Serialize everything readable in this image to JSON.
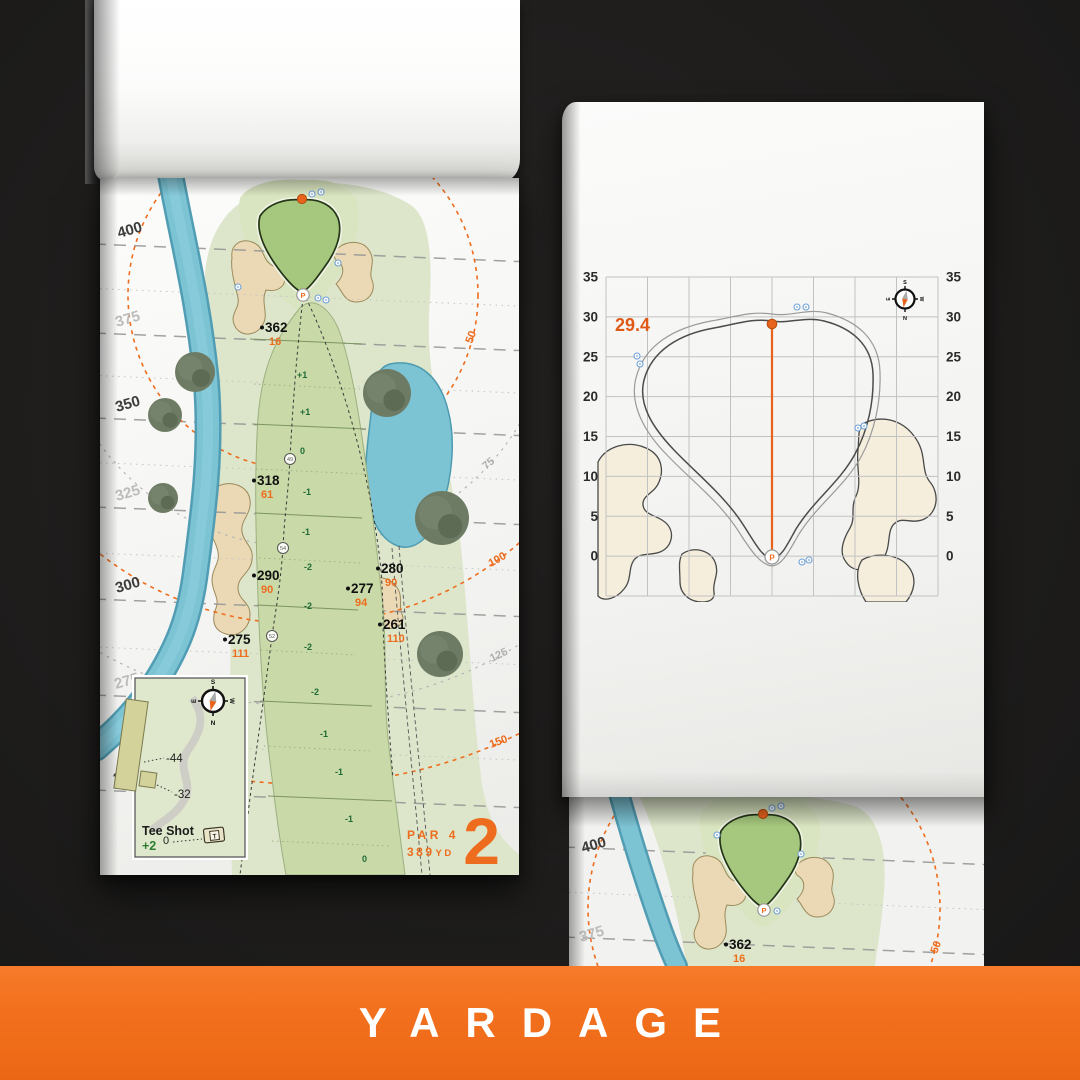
{
  "banner": {
    "label": "YARDAGE",
    "bg": "#f2701d",
    "text_color": "#ffffff"
  },
  "colors": {
    "accent_orange": "#ee6c1d",
    "fairway_green": "#c9d9a8",
    "putting_green": "#a6c87e",
    "water_blue": "#7cc3d4",
    "sand_tan": "#ead9b4",
    "elevation_green": "#1e6b34",
    "ruler_dark": "#3c3c3c",
    "ruler_light": "#bcbcbc"
  },
  "shared": {
    "pin": "P"
  },
  "hole_page": {
    "number": "2",
    "par": "PAR 4",
    "yards": "389",
    "yards_unit": "YD",
    "tee_inset": {
      "title": "Tee Shot",
      "elevation": "+2",
      "back_tee": "-44",
      "mid_tee": "-32",
      "front": "0",
      "tee_icon": "T"
    },
    "compass": {
      "n": "N",
      "s": "S",
      "e": "E",
      "w": "W"
    },
    "ruler": [
      {
        "label": "400",
        "x": 19,
        "y": 60,
        "tone": "dark"
      },
      {
        "label": "375",
        "x": 17,
        "y": 149,
        "tone": "light"
      },
      {
        "label": "350",
        "x": 17,
        "y": 234,
        "tone": "dark"
      },
      {
        "label": "325",
        "x": 17,
        "y": 323,
        "tone": "light"
      },
      {
        "label": "300",
        "x": 17,
        "y": 415,
        "tone": "dark"
      },
      {
        "label": "275",
        "x": 16,
        "y": 511,
        "tone": "light"
      },
      {
        "label": "250",
        "x": 15,
        "y": 606,
        "tone": "dark"
      }
    ],
    "arc_labels": [
      {
        "label": "50",
        "x": 372,
        "y": 166,
        "rot": -70,
        "tone": "orange"
      },
      {
        "label": "75",
        "x": 386,
        "y": 292,
        "rot": -40,
        "tone": "gray"
      },
      {
        "label": "100",
        "x": 391,
        "y": 389,
        "rot": -30,
        "tone": "orange"
      },
      {
        "label": "125",
        "x": 392,
        "y": 484,
        "rot": -26,
        "tone": "gray"
      },
      {
        "label": "150",
        "x": 391,
        "y": 570,
        "rot": -20,
        "tone": "orange"
      }
    ],
    "markers": [
      {
        "main": "362",
        "sub": "16",
        "x": 165,
        "y": 154
      },
      {
        "main": "318",
        "sub": "61",
        "x": 157,
        "y": 307
      },
      {
        "main": "290",
        "sub": "90",
        "x": 157,
        "y": 402
      },
      {
        "main": "275",
        "sub": "111",
        "x": 128,
        "y": 466
      },
      {
        "main": "280",
        "sub": "90",
        "x": 281,
        "y": 395
      },
      {
        "main": "277",
        "sub": "94",
        "x": 251,
        "y": 415
      },
      {
        "main": "261",
        "sub": "110",
        "x": 283,
        "y": 451
      }
    ],
    "elevations": [
      {
        "v": "+1",
        "x": 197,
        "y": 200
      },
      {
        "v": "+1",
        "x": 200,
        "y": 237
      },
      {
        "v": "0",
        "x": 200,
        "y": 276
      },
      {
        "v": "-1",
        "x": 203,
        "y": 317
      },
      {
        "v": "-1",
        "x": 202,
        "y": 357
      },
      {
        "v": "-2",
        "x": 204,
        "y": 392
      },
      {
        "v": "-2",
        "x": 204,
        "y": 431
      },
      {
        "v": "-2",
        "x": 204,
        "y": 472
      },
      {
        "v": "-2",
        "x": 211,
        "y": 517
      },
      {
        "v": "-1",
        "x": 220,
        "y": 559
      },
      {
        "v": "-1",
        "x": 235,
        "y": 597
      },
      {
        "v": "-1",
        "x": 245,
        "y": 644
      },
      {
        "v": "0",
        "x": 262,
        "y": 684
      }
    ],
    "waypoints": [
      {
        "v": "49",
        "x": 190,
        "y": 281
      },
      {
        "v": "54",
        "x": 183,
        "y": 370
      },
      {
        "v": "52",
        "x": 172,
        "y": 458
      }
    ]
  },
  "green_page": {
    "depth": "29.4",
    "axis_values": [
      "35",
      "30",
      "25",
      "20",
      "15",
      "10",
      "5",
      "0"
    ],
    "compass": {
      "n": "N",
      "s": "S",
      "e": "E",
      "w": "W"
    }
  },
  "next_page": {
    "ruler": [
      {
        "label": "400",
        "x": 14,
        "y": 56,
        "tone": "dark"
      },
      {
        "label": "375",
        "x": 12,
        "y": 145,
        "tone": "light"
      }
    ],
    "marker": {
      "main": "362",
      "sub": "16",
      "x": 160,
      "y": 152
    },
    "arc_label": {
      "label": "50",
      "x": 368,
      "y": 157,
      "rot": -70
    }
  }
}
